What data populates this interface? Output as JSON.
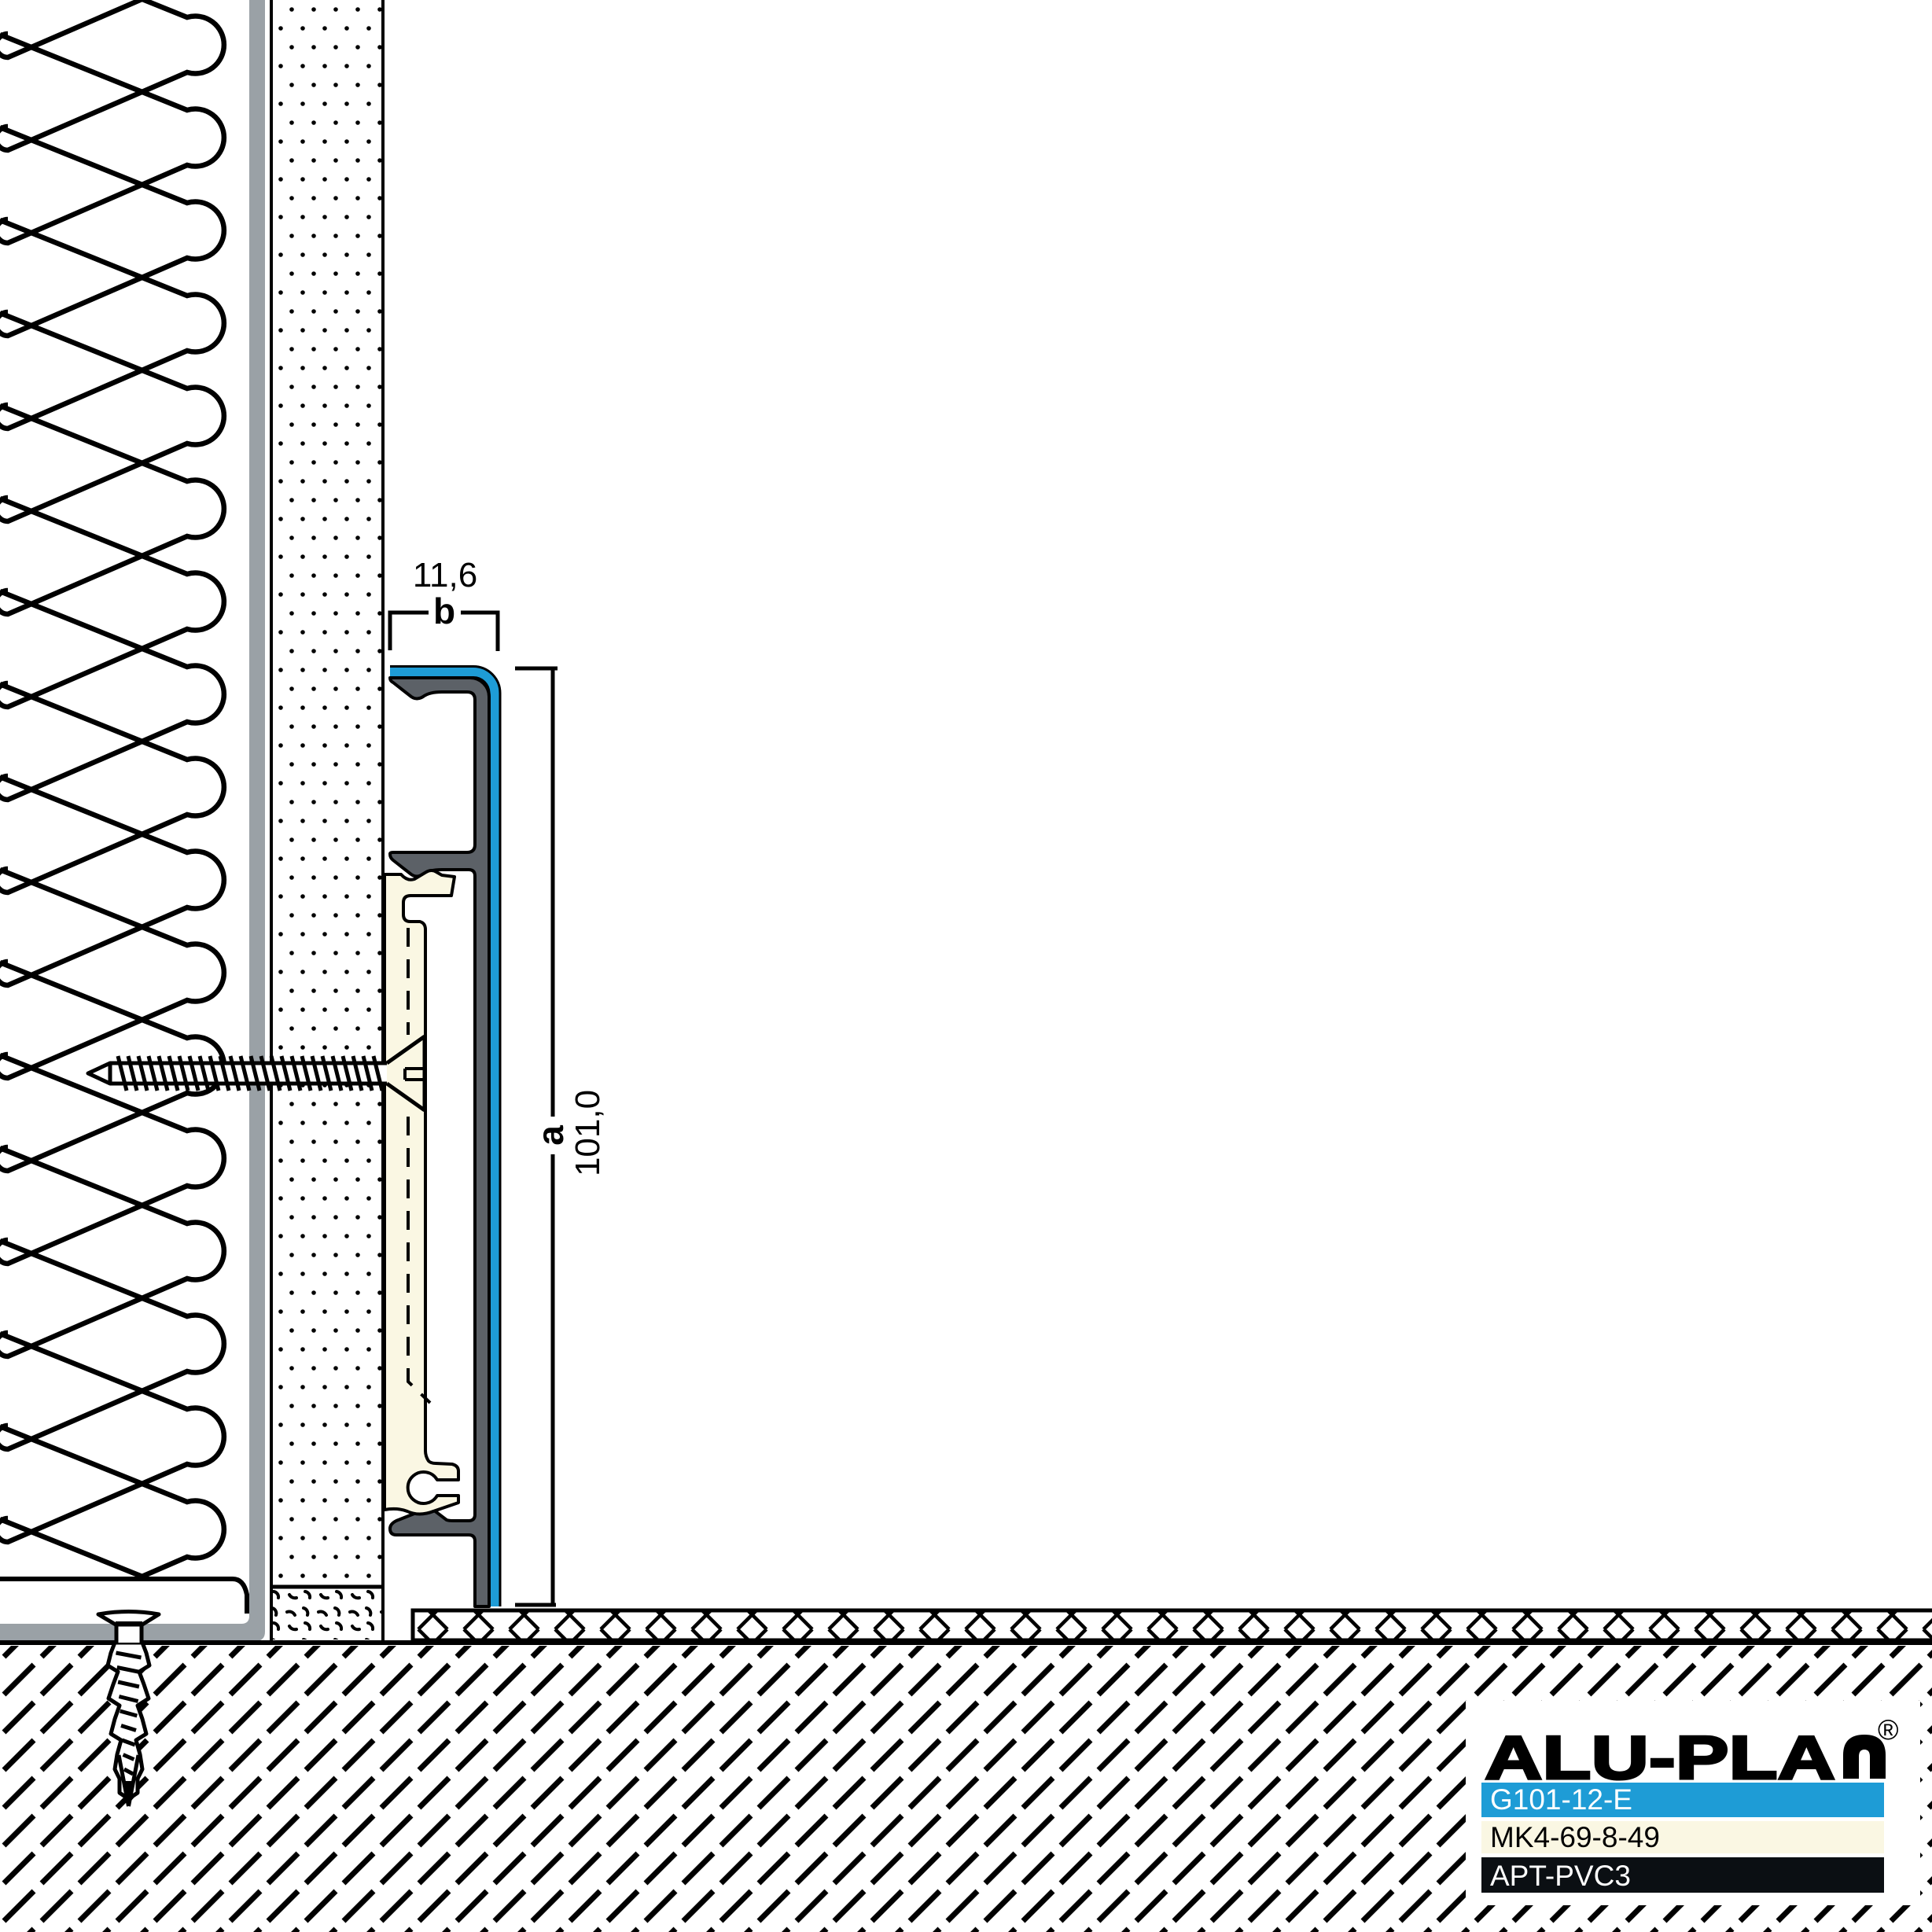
{
  "drawing": {
    "dimensions": {
      "width": {
        "label": "b",
        "value": "11,6"
      },
      "height": {
        "label": "a",
        "value": "101,0"
      }
    },
    "title_block": {
      "brand": "ALU-PLAN",
      "brand_prefix": "ALU-PLA",
      "registered": "®",
      "rows": [
        {
          "code": "G101-12-E",
          "bg": "#1E9CD6",
          "fg": "#FFFFFF"
        },
        {
          "code": "MK4-69-8-49",
          "bg": "#FAF7E3",
          "fg": "#000000"
        },
        {
          "code": "APT-PVC3",
          "bg": "#0B0F13",
          "fg": "#FFFFFF"
        }
      ]
    },
    "colors": {
      "cover_blue": "#1E9CD6",
      "profile_gray": "#5C6167",
      "wall_liner_gray": "#9AA1A6",
      "clip_cream": "#FAF7E3",
      "line_black": "#000000"
    }
  }
}
